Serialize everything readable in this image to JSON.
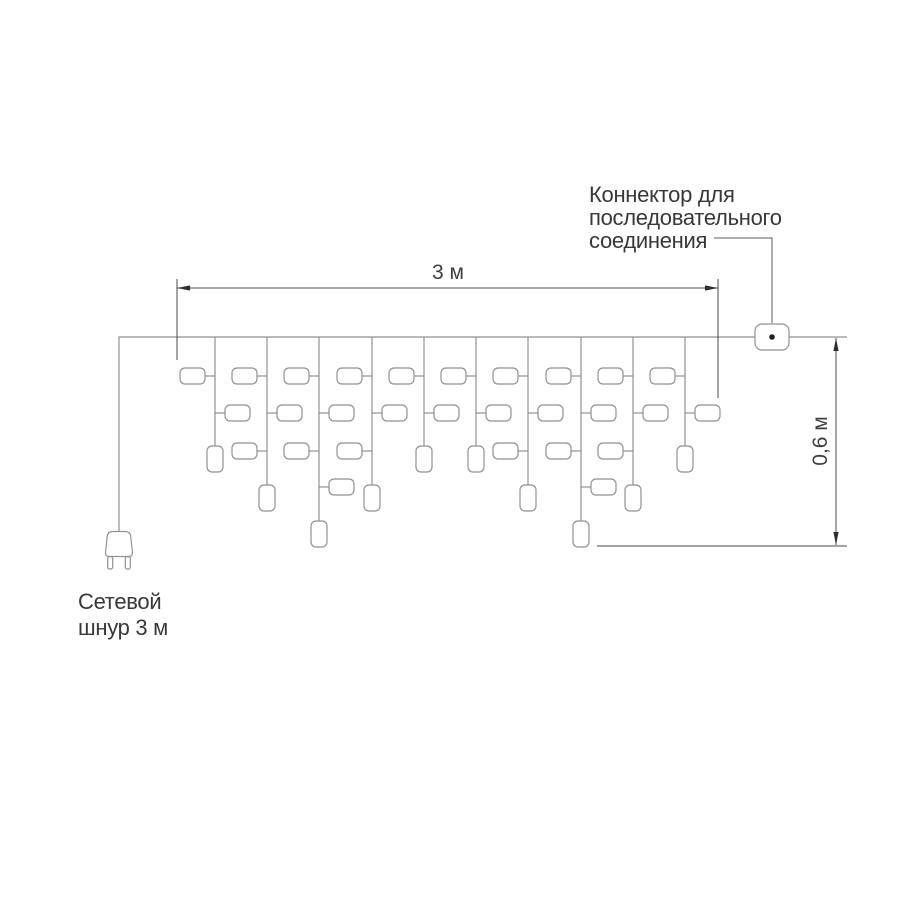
{
  "colors": {
    "background": "#ffffff",
    "garland": "#919191",
    "dimension": "#4a4a4a",
    "arrow": "#2e2e2e",
    "leader": "#5a5a5a",
    "text": "#383838",
    "connector_dot": "#222222"
  },
  "labels": {
    "connector_lines": [
      "Коннектор для",
      "последовательного",
      "соединения"
    ],
    "power_cord_lines": [
      "Сетевой",
      "шнур 3 м"
    ]
  },
  "garland": {
    "wire": {
      "y": 337,
      "x1": 119,
      "x2": 847
    },
    "cord": {
      "x": 119,
      "bottom_y": 531
    },
    "connector_box": {
      "x": 755,
      "y": 324,
      "w": 34,
      "h": 26,
      "rx": 7,
      "dot_r": 2.8
    },
    "light": {
      "w": 25,
      "h": 16,
      "rx": 5,
      "gap": 10
    },
    "light_rows_y": [
      376,
      413,
      451,
      487
    ],
    "light_row_sides": [
      "left",
      "right",
      "left",
      "right"
    ],
    "bulb": {
      "w": 16,
      "h": 26,
      "rx": 5
    },
    "bulb_top": {
      "2": 446,
      "3": 485,
      "4": 521
    },
    "drops": [
      {
        "x": 215,
        "lights": 2
      },
      {
        "x": 267,
        "lights": 3
      },
      {
        "x": 319,
        "lights": 4
      },
      {
        "x": 372,
        "lights": 3
      },
      {
        "x": 424,
        "lights": 2
      },
      {
        "x": 476,
        "lights": 2
      },
      {
        "x": 528,
        "lights": 3
      },
      {
        "x": 581,
        "lights": 4
      },
      {
        "x": 633,
        "lights": 3
      },
      {
        "x": 685,
        "lights": 2
      }
    ]
  },
  "dimensions": {
    "width": {
      "label": "3 м",
      "x1": 177,
      "x2": 718,
      "y": 288,
      "ext_top": 279,
      "ext_bottom_left": 360,
      "ext_bottom_right": 398
    },
    "height": {
      "label": "0,6 м",
      "x": 836,
      "y1": 338,
      "y2": 545,
      "ref_y": 546,
      "ref_x1": 597,
      "ref_x2": 847
    }
  },
  "leader": {
    "x1": 714,
    "y1": 238,
    "x2": 772,
    "y2": 323
  }
}
